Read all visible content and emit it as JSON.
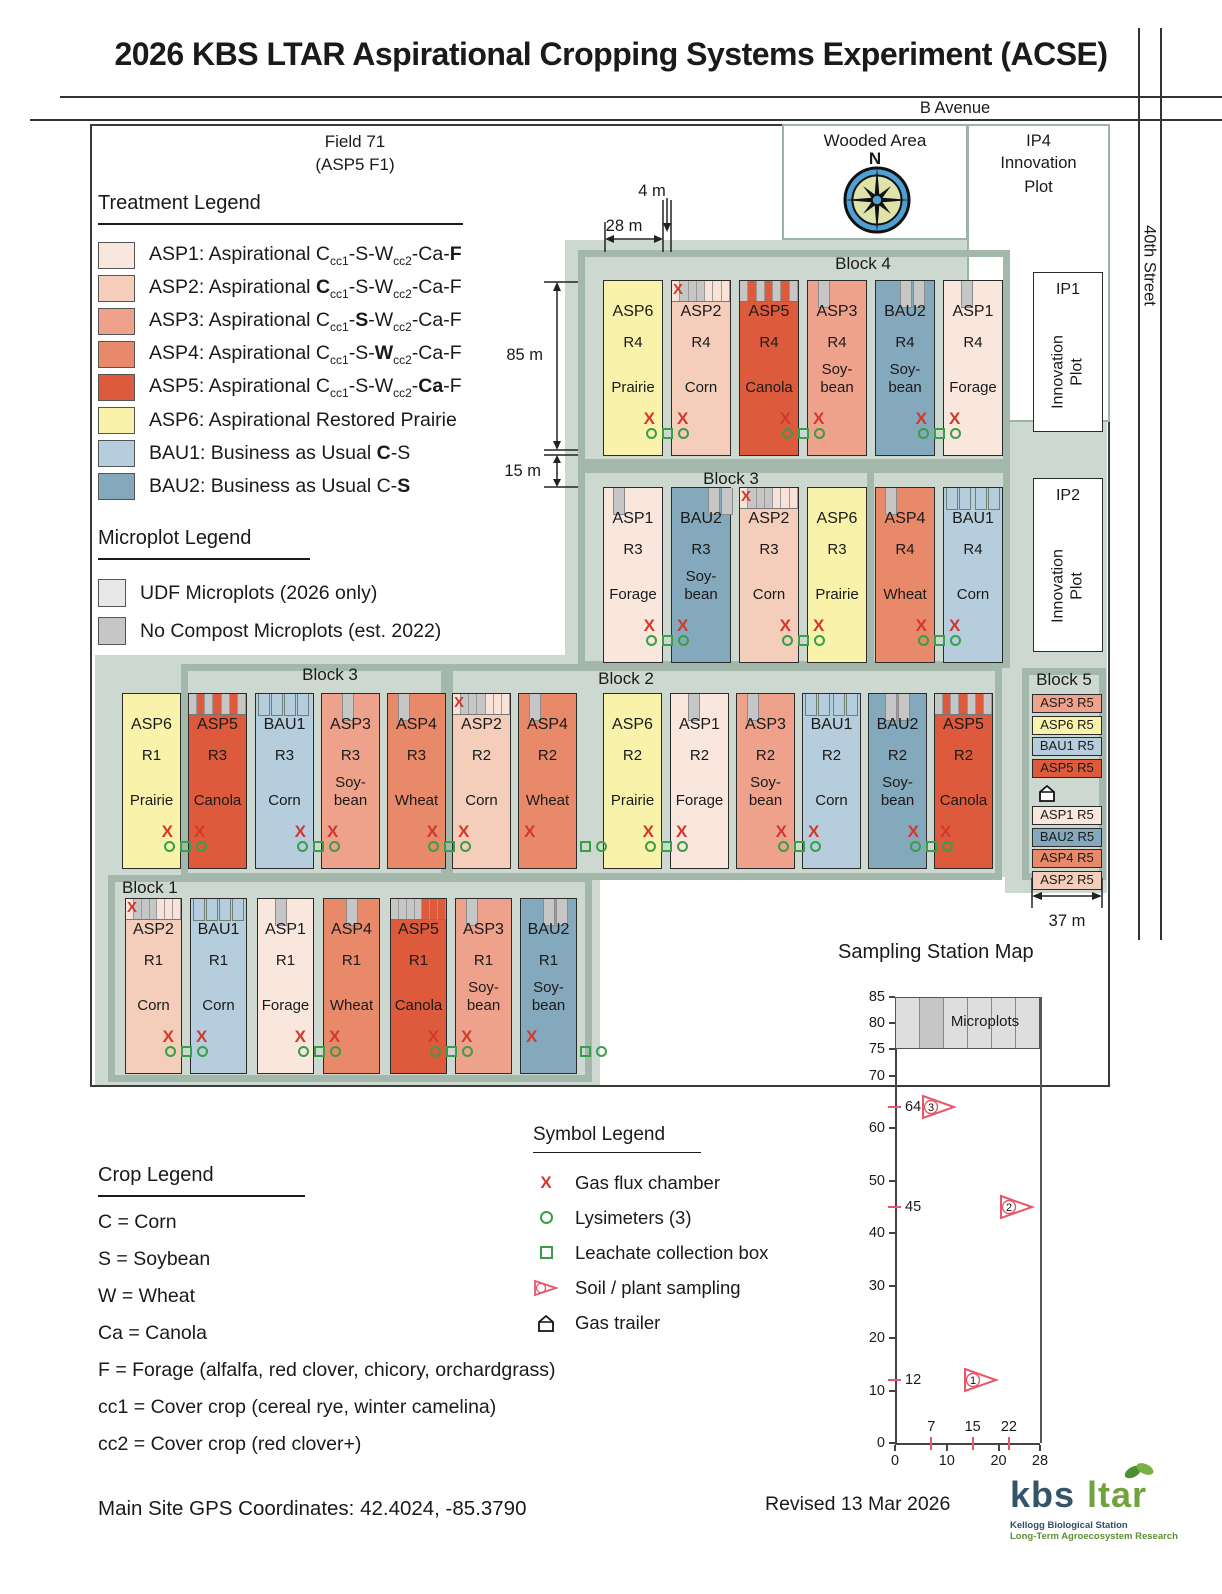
{
  "title": "2026 KBS LTAR Aspirational Cropping Systems Experiment (ACSE)",
  "roads": {
    "b_avenue": "B Avenue",
    "street": "40th Street"
  },
  "field": {
    "label_line1": "Field 71",
    "label_line2": "(ASP5 F1)",
    "wooded_area": "Wooded Area",
    "north": "N",
    "ip4_id": "IP4",
    "ip4_label": "Innovation Plot",
    "ip1_id": "IP1",
    "ip1_label": "Innovation Plot",
    "ip2_id": "IP2",
    "ip2_label": "Innovation Plot",
    "block_labels": {
      "b4": "Block 4",
      "b3_top": "Block 3",
      "b3_bottom": "Block 3",
      "b2": "Block 2",
      "b1": "Block 1",
      "b5": "Block 5"
    },
    "dims": {
      "w4": "4 m",
      "w28": "28 m",
      "h85": "85 m",
      "h15": "15 m",
      "w37": "37 m"
    },
    "rows": [
      {
        "plots": [
          {
            "code": "ASP6",
            "rep": "R4",
            "crop": "Prairie",
            "fill": "asp6",
            "flux": "right",
            "top": {
              "kind": "none"
            }
          },
          {
            "code": "ASP2",
            "rep": "R4",
            "crop": "Corn",
            "fill": "asp2",
            "flux": "left",
            "top": {
              "kind": "strip",
              "x": true,
              "gray": [
                1,
                2,
                3
              ]
            }
          },
          {
            "code": "ASP5",
            "rep": "R4",
            "crop": "Canola",
            "fill": "asp5",
            "flux": "right",
            "top": {
              "kind": "strip",
              "gray": [
                0,
                2,
                4,
                6
              ]
            }
          },
          {
            "code": "ASP3",
            "rep": "R4",
            "crop": "Soy-\nbean",
            "fill": "asp3",
            "flux": "left",
            "top": {
              "kind": "tab",
              "n": 1,
              "at": 18
            }
          },
          {
            "code": "BAU2",
            "rep": "R4",
            "crop": "Soy-\nbean",
            "fill": "bau2",
            "flux": "right",
            "top": {
              "kind": "tab",
              "n": 2,
              "at": 42
            }
          },
          {
            "code": "ASP1",
            "rep": "R4",
            "crop": "Forage",
            "fill": "asp1",
            "flux": "left",
            "top": {
              "kind": "tab",
              "n": 1,
              "at": 30
            }
          }
        ],
        "clusters": [
          0,
          2,
          4
        ],
        "partials": []
      },
      {
        "plots": [
          {
            "code": "ASP1",
            "rep": "R3",
            "crop": "Forage",
            "fill": "asp1",
            "flux": "right",
            "top": {
              "kind": "tab",
              "n": 1,
              "at": 15
            }
          },
          {
            "code": "BAU2",
            "rep": "R3",
            "crop": "Soy-\nbean",
            "fill": "bau2",
            "flux": "left",
            "top": {
              "kind": "tab",
              "n": 2,
              "at": 62
            }
          },
          {
            "code": "ASP2",
            "rep": "R3",
            "crop": "Corn",
            "fill": "asp2",
            "flux": "right",
            "top": {
              "kind": "strip",
              "x": true,
              "gray": [
                1,
                2,
                3
              ]
            }
          },
          {
            "code": "ASP6",
            "rep": "R3",
            "crop": "Prairie",
            "fill": "asp6",
            "flux": "left",
            "top": {
              "kind": "none"
            }
          },
          {
            "code": "ASP4",
            "rep": "R4",
            "crop": "Wheat",
            "fill": "asp4",
            "flux": "right",
            "top": {
              "kind": "tab",
              "n": 1,
              "at": 15
            }
          },
          {
            "code": "BAU1",
            "rep": "R4",
            "crop": "Corn",
            "fill": "bau1",
            "flux": "left",
            "top": {
              "kind": "outline",
              "layout": "split"
            }
          }
        ],
        "clusters": [
          0,
          2,
          4
        ],
        "partials": []
      },
      {
        "plots": [
          {
            "code": "ASP6",
            "rep": "R1",
            "crop": "Prairie",
            "fill": "asp6",
            "flux": "right",
            "top": {
              "kind": "none"
            }
          },
          {
            "code": "ASP5",
            "rep": "R3",
            "crop": "Canola",
            "fill": "asp5",
            "flux": "left",
            "top": {
              "kind": "strip",
              "gray": [
                0,
                2,
                4,
                6
              ]
            }
          },
          {
            "code": "BAU1",
            "rep": "R3",
            "crop": "Corn",
            "fill": "bau1",
            "flux": "right",
            "top": {
              "kind": "outline",
              "layout": "left"
            }
          },
          {
            "code": "ASP3",
            "rep": "R3",
            "crop": "Soy-\nbean",
            "fill": "asp3",
            "flux": "left",
            "top": {
              "kind": "tab",
              "n": 1,
              "at": 35
            }
          },
          {
            "code": "ASP4",
            "rep": "R3",
            "crop": "Wheat",
            "fill": "asp4",
            "flux": "right",
            "top": {
              "kind": "tab",
              "n": 1,
              "at": 18
            }
          },
          {
            "code": "ASP2",
            "rep": "R2",
            "crop": "Corn",
            "fill": "asp2",
            "flux": "left",
            "top": {
              "kind": "strip",
              "x": true,
              "gray": [
                1,
                2,
                3
              ]
            }
          },
          {
            "code": "ASP4",
            "rep": "R2",
            "crop": "Wheat",
            "fill": "asp4",
            "flux": "left",
            "top": {
              "kind": "tab",
              "n": 1,
              "at": 18
            }
          },
          {
            "code": "ASP6",
            "rep": "R2",
            "crop": "Prairie",
            "fill": "asp6",
            "flux": "right",
            "top": {
              "kind": "none"
            }
          },
          {
            "code": "ASP1",
            "rep": "R2",
            "crop": "Forage",
            "fill": "asp1",
            "flux": "left",
            "top": {
              "kind": "tab",
              "n": 1,
              "at": 30
            }
          },
          {
            "code": "ASP3",
            "rep": "R2",
            "crop": "Soy-\nbean",
            "fill": "asp3",
            "flux": "right",
            "top": {
              "kind": "tab",
              "n": 1,
              "at": 18
            }
          },
          {
            "code": "BAU1",
            "rep": "R2",
            "crop": "Corn",
            "fill": "bau1",
            "flux": "left",
            "top": {
              "kind": "outline",
              "layout": "split"
            }
          },
          {
            "code": "BAU2",
            "rep": "R2",
            "crop": "Soy-\nbean",
            "fill": "bau2",
            "flux": "right",
            "top": {
              "kind": "tab",
              "n": 2,
              "at": 28
            }
          },
          {
            "code": "ASP5",
            "rep": "R2",
            "crop": "Canola",
            "fill": "asp5",
            "flux": "left",
            "top": {
              "kind": "strip",
              "gray": [
                0,
                2,
                4,
                6
              ]
            }
          }
        ],
        "clusters": [
          0,
          2,
          4,
          7,
          9,
          11
        ],
        "partials": [
          6
        ]
      },
      {
        "plots": [
          {
            "code": "ASP2",
            "rep": "R1",
            "crop": "Corn",
            "fill": "asp2",
            "flux": "right",
            "top": {
              "kind": "strip",
              "x": true,
              "gray": [
                1,
                2,
                3
              ]
            }
          },
          {
            "code": "BAU1",
            "rep": "R1",
            "crop": "Corn",
            "fill": "bau1",
            "flux": "left",
            "top": {
              "kind": "outline",
              "layout": "split"
            }
          },
          {
            "code": "ASP1",
            "rep": "R1",
            "crop": "Forage",
            "fill": "asp1",
            "flux": "right",
            "top": {
              "kind": "tab",
              "n": 1,
              "at": 30
            }
          },
          {
            "code": "ASP4",
            "rep": "R1",
            "crop": "Wheat",
            "fill": "asp4",
            "flux": "left",
            "top": {
              "kind": "tab",
              "n": 1,
              "at": 40
            }
          },
          {
            "code": "ASP5",
            "rep": "R1",
            "crop": "Canola",
            "fill": "asp5",
            "flux": "right",
            "top": {
              "kind": "strip",
              "gray": [
                0,
                1,
                2,
                3
              ]
            }
          },
          {
            "code": "ASP3",
            "rep": "R1",
            "crop": "Soy-\nbean",
            "fill": "asp3",
            "flux": "left",
            "top": {
              "kind": "tab",
              "n": 1,
              "at": 18
            }
          },
          {
            "code": "BAU2",
            "rep": "R1",
            "crop": "Soy-\nbean",
            "fill": "bau2",
            "flux": "left",
            "top": {
              "kind": "tab",
              "n": 2,
              "at": 40
            }
          }
        ],
        "clusters": [
          0,
          2,
          4
        ],
        "partials": [
          6
        ]
      }
    ],
    "block5_strips": [
      {
        "text": "ASP3 R5",
        "fill": "asp3"
      },
      {
        "text": "ASP6 R5",
        "fill": "asp6"
      },
      {
        "text": "BAU1 R5",
        "fill": "bau1"
      },
      {
        "text": "ASP5 R5",
        "fill": "asp5"
      },
      {
        "trailer": true
      },
      {
        "text": "ASP1 R5",
        "fill": "asp1"
      },
      {
        "text": "BAU2 R5",
        "fill": "bau2"
      },
      {
        "text": "ASP4 R5",
        "fill": "asp4"
      },
      {
        "text": "ASP2 R5",
        "fill": "asp2"
      }
    ]
  },
  "treatment_legend": {
    "title": "Treatment Legend",
    "items": [
      {
        "fill": "asp1",
        "label": "ASP1: Aspirational C_cc1_-S-W_cc2_-Ca-*F*"
      },
      {
        "fill": "asp2",
        "label": "ASP2: Aspirational *C*_cc1_-S-W_cc2_-Ca-F"
      },
      {
        "fill": "asp3",
        "label": "ASP3: Aspirational C_cc1_-*S*-W_cc2_-Ca-F"
      },
      {
        "fill": "asp4",
        "label": "ASP4: Aspirational C_cc1_-S-*W*_cc2_-Ca-F"
      },
      {
        "fill": "asp5",
        "label": "ASP5: Aspirational C_cc1_-S-W_cc2_-*Ca*-F"
      },
      {
        "fill": "asp6",
        "label": "ASP6: Aspirational Restored Prairie"
      },
      {
        "fill": "bau1",
        "label": "BAU1: Business as Usual *C*-S"
      },
      {
        "fill": "bau2",
        "label": "BAU2: Business as Usual C-*S*"
      }
    ]
  },
  "microplot_legend": {
    "title": "Microplot Legend",
    "items": [
      {
        "color": "#e8e8e8",
        "label": "UDF Microplots (2026 only)"
      },
      {
        "color": "#c6c6c6",
        "label": "No Compost Microplots (est. 2022)"
      }
    ]
  },
  "crop_legend": {
    "title": "Crop Legend",
    "lines": [
      "C = Corn",
      "S = Soybean",
      "W = Wheat",
      "Ca = Canola",
      "F = Forage (alfalfa, red clover, chicory, orchardgrass)",
      "cc1 = Cover crop (cereal rye, winter camelina)",
      "cc2 = Cover crop (red clover+)"
    ]
  },
  "symbol_legend": {
    "title": "Symbol Legend",
    "items": [
      {
        "icon": "gas-flux-x",
        "label": "Gas flux chamber"
      },
      {
        "icon": "lysimeter-circle",
        "label": "Lysimeters (3)"
      },
      {
        "icon": "leachate-square",
        "label": "Leachate collection box"
      },
      {
        "icon": "sampling-flag",
        "label": "Soil / plant sampling"
      },
      {
        "icon": "gas-trailer",
        "label": "Gas trailer"
      }
    ]
  },
  "sampling_map": {
    "title": "Sampling Station Map",
    "chart_data": {
      "type": "scatter",
      "title": "Sampling Station Map",
      "xlim": [
        0,
        28
      ],
      "ylim": [
        0,
        85
      ],
      "x_ticks": [
        0,
        10,
        20,
        28
      ],
      "y_ticks": [
        85,
        80,
        75,
        70,
        60,
        50,
        40,
        30,
        20,
        10,
        0
      ],
      "station_x_ticks": [
        7,
        15,
        22
      ],
      "station_y_ticks": [
        64,
        45,
        12
      ],
      "stations": [
        {
          "id": 1,
          "x": 15,
          "y": 12
        },
        {
          "id": 2,
          "x": 22,
          "y": 45
        },
        {
          "id": 3,
          "x": 7,
          "y": 64
        }
      ],
      "microplots_band": {
        "from": 75,
        "to": 85,
        "label": "Microplots",
        "cells": 6,
        "dark_cell": 1
      }
    }
  },
  "footer": {
    "gps": "Main Site GPS Coordinates: 42.4024, -85.3790",
    "revised": "Revised 13 Mar 2026",
    "logo_kbs": "kbs",
    "logo_ltar": "ltar",
    "logo_sub1": "Kellogg Biological Station",
    "logo_sub2": "Long-Term Agroecosystem Research"
  },
  "colors": {
    "asp1": "#f9e6dd",
    "asp2": "#f4cdbb",
    "asp3": "#efa28b",
    "asp4": "#e8896a",
    "asp5": "#dd5b3c",
    "asp6": "#f8f2ab",
    "bau1": "#b5cddd",
    "bau2": "#84a8bc",
    "udf_gray": "#e8e8e8",
    "nocompost_gray": "#c6c6c6",
    "sage": "#cdd9d0",
    "block_border": "#a3b8ab",
    "flux_red": "#d2392c",
    "symbol_green": "#3a9e49",
    "flag_red": "#e8566b",
    "logo_blue": "#335469",
    "logo_green": "#71a33c"
  }
}
